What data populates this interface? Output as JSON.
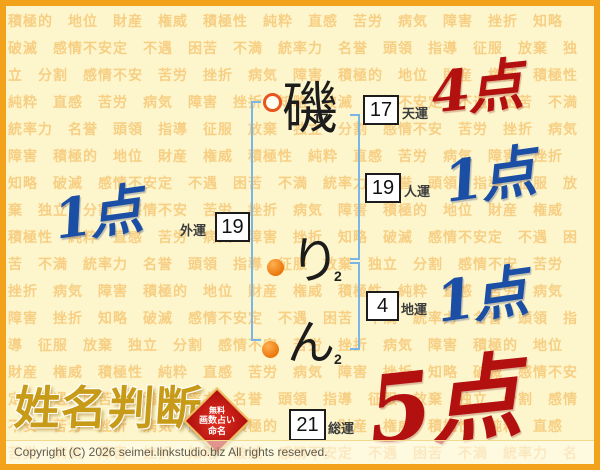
{
  "background": {
    "words": [
      "積極的",
      "地位",
      "財産",
      "権威",
      "積極性",
      "純粋",
      "直感",
      "苦労",
      "病気",
      "障害",
      "挫折",
      "知略",
      "破滅",
      "感情不安定",
      "不遇",
      "困苦",
      "不満",
      "統率力",
      "名誉",
      "頭領",
      "指導",
      "征服",
      "放棄",
      "独立",
      "分割",
      "感情不安",
      "苦労",
      "挫折",
      "病気",
      "障害"
    ]
  },
  "name": {
    "chars": [
      {
        "char": "磯",
        "strokes": "17",
        "marker": "open-circle"
      },
      {
        "char": "り",
        "strokes": "2",
        "marker": "filled-circle"
      },
      {
        "char": "ん",
        "strokes": "2",
        "marker": "filled-circle"
      }
    ]
  },
  "fortunes": [
    {
      "id": "tenun",
      "value": "17",
      "label": "天運",
      "score": "4点",
      "score_color": "#b31010"
    },
    {
      "id": "jinun",
      "value": "19",
      "label": "人運",
      "score": "1点",
      "score_color": "#1b4fa5"
    },
    {
      "id": "chiun",
      "value": "4",
      "label": "地運",
      "score": "1点",
      "score_color": "#1b4fa5"
    },
    {
      "id": "gaiun",
      "value": "19",
      "label": "外運",
      "score": "1点",
      "score_color": "#1b4fa5"
    },
    {
      "id": "souun",
      "value": "21",
      "label": "総運",
      "score": "5点",
      "score_color": "#b31010"
    }
  ],
  "branding": {
    "logo_text": "姓名判断",
    "seal_lines": [
      "無料",
      "画数占い",
      "命名"
    ]
  },
  "footer": {
    "copyright": "Copyright (C) 2026 seimei.linkstudio.biz All rights reserved."
  },
  "colors": {
    "border": "#f2a31b",
    "background": "#fdf6cc",
    "pattern_text": "#f3ae48",
    "bracket": "#79b5e6",
    "score_red": "#b31010",
    "score_blue": "#1b4fa5",
    "logo_gold": "#c79b18",
    "seal_red": "#c01515"
  }
}
